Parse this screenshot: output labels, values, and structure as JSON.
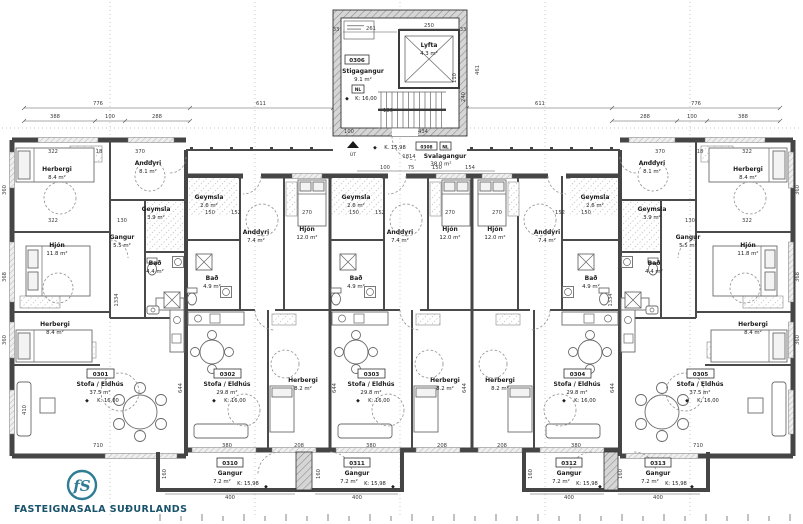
{
  "brand": {
    "monogram": "fS",
    "name": "FASTEIGNASALA SUÐURLANDS"
  },
  "symbols": {
    "level_marker": "◆"
  },
  "stairwell": {
    "id": "0306",
    "name": "Stigagangur",
    "area": "9.1 m²",
    "marker": "NL",
    "level": "K: 16,00",
    "exit": "ÚT",
    "elevator": {
      "name": "Lyfta",
      "area": "4.3 m²"
    },
    "dims": {
      "top": "250",
      "upper": "261",
      "left_t": "33",
      "right_t": "33",
      "bottom": "434",
      "entry": "100",
      "height": "461",
      "flight": "240",
      "landing": "110",
      "run": "180"
    }
  },
  "walkway": {
    "id": "0308",
    "marker": "NL",
    "name": "Svalagangur",
    "area": "38.0 m²",
    "level": "K. 15,98",
    "length": "1814",
    "row": [
      "100",
      "75",
      "150",
      "154"
    ]
  },
  "apartments": [
    {
      "id": "0301",
      "name": "Stofa / Eldhús",
      "area": "37.5 m²",
      "level": "K: 16,00"
    },
    {
      "id": "0302",
      "name": "Stofa / Eldhús",
      "area": "29.8 m²",
      "level": "K: 16,00"
    },
    {
      "id": "0303",
      "name": "Stofa / Eldhús",
      "area": "29.8 m²",
      "level": "K: 16,00"
    },
    {
      "id": "0304",
      "name": "Stofa / Eldhús",
      "area": "29.8 m²",
      "level": "K: 16,00"
    },
    {
      "id": "0305",
      "name": "Stofa / Eldhús",
      "area": "37.5 m²",
      "level": "K: 16,00"
    }
  ],
  "rooms": [
    {
      "name": "Herbergi",
      "area": "8.4 m²"
    },
    {
      "name": "Anddyri",
      "area": "8.1 m²"
    },
    {
      "name": "Hjón",
      "area": "11.8 m²"
    },
    {
      "name": "Gangur",
      "area": "5.5 m²"
    },
    {
      "name": "Geymsla",
      "area": "3.9 m²"
    },
    {
      "name": "Bað",
      "area": "4.4 m²"
    },
    {
      "name": "Herbergi",
      "area": "8.4 m²"
    },
    {
      "name": "Geymsla",
      "area": "2.6 m²"
    },
    {
      "name": "Anddyri",
      "area": "7.4 m²"
    },
    {
      "name": "Hjón",
      "area": "12.0 m²"
    },
    {
      "name": "Bað",
      "area": "4.9 m²"
    },
    {
      "name": "Herbergi",
      "area": "8.2 m²"
    },
    {
      "name": "Geymsla",
      "area": "2.6 m²"
    },
    {
      "name": "Anddyri",
      "area": "7.4 m²"
    },
    {
      "name": "Hjón",
      "area": "12.0 m²"
    },
    {
      "name": "Bað",
      "area": "4.9 m²"
    },
    {
      "name": "Herbergi",
      "area": "8.2 m²"
    },
    {
      "name": "Hjón",
      "area": "12.0 m²"
    },
    {
      "name": "Anddyri",
      "area": "7.4 m²"
    },
    {
      "name": "Geymsla",
      "area": "2.6 m²"
    },
    {
      "name": "Bað",
      "area": "4.9 m²"
    },
    {
      "name": "Herbergi",
      "area": "8.2 m²"
    },
    {
      "name": "Anddyri",
      "area": "8.1 m²"
    },
    {
      "name": "Geymsla",
      "area": "3.9 m²"
    },
    {
      "name": "Bað",
      "area": "4.4 m²"
    },
    {
      "name": "Gangur",
      "area": "5.5 m²"
    },
    {
      "name": "Hjón",
      "area": "11.8 m²"
    },
    {
      "name": "Herbergi",
      "area": "8.4 m²"
    },
    {
      "name": "Herbergi",
      "area": "8.4 m²"
    }
  ],
  "corridors": [
    {
      "id": "0310",
      "name": "Gangur",
      "area": "7.2 m²",
      "level": "K: 15,98",
      "width": "400",
      "depth": "160"
    },
    {
      "id": "0311",
      "name": "Gangur",
      "area": "7.2 m²",
      "level": "K: 15,98",
      "width": "400",
      "depth": "160"
    },
    {
      "id": "0312",
      "name": "Gangur",
      "area": "7.2 m²",
      "level": "K: 15,98",
      "width": "400",
      "depth": "160"
    },
    {
      "id": "0313",
      "name": "Gangur",
      "area": "7.2 m²",
      "level": "K: 15,98",
      "width": "400",
      "depth": "160"
    }
  ],
  "dims": {
    "top": {
      "l1": "776",
      "l2": "611",
      "r1": "611",
      "r2": "776",
      "lp": [
        "388",
        "100",
        "288"
      ],
      "rp": [
        "288",
        "100",
        "388"
      ]
    },
    "edge_left": [
      "360",
      "368",
      "360"
    ],
    "edge_right": [
      "360",
      "368",
      "360"
    ],
    "row_top_left": [
      "322",
      "18",
      "370"
    ],
    "row_top_right": [
      "370",
      "18",
      "322"
    ],
    "row_mid_left": [
      "322",
      "130"
    ],
    "row_mid_right": [
      "130",
      "322"
    ],
    "unit_rows": {
      "u2": [
        "150",
        "152",
        "270"
      ],
      "u3": [
        "150",
        "152",
        "270"
      ],
      "u4": [
        "270",
        "152",
        "150"
      ]
    },
    "bottom": [
      "710",
      "380",
      "208",
      "380",
      "208",
      "208",
      "380",
      "710"
    ],
    "vert": [
      "644",
      "644",
      "644",
      "644",
      "1334",
      "1334",
      "410"
    ]
  }
}
